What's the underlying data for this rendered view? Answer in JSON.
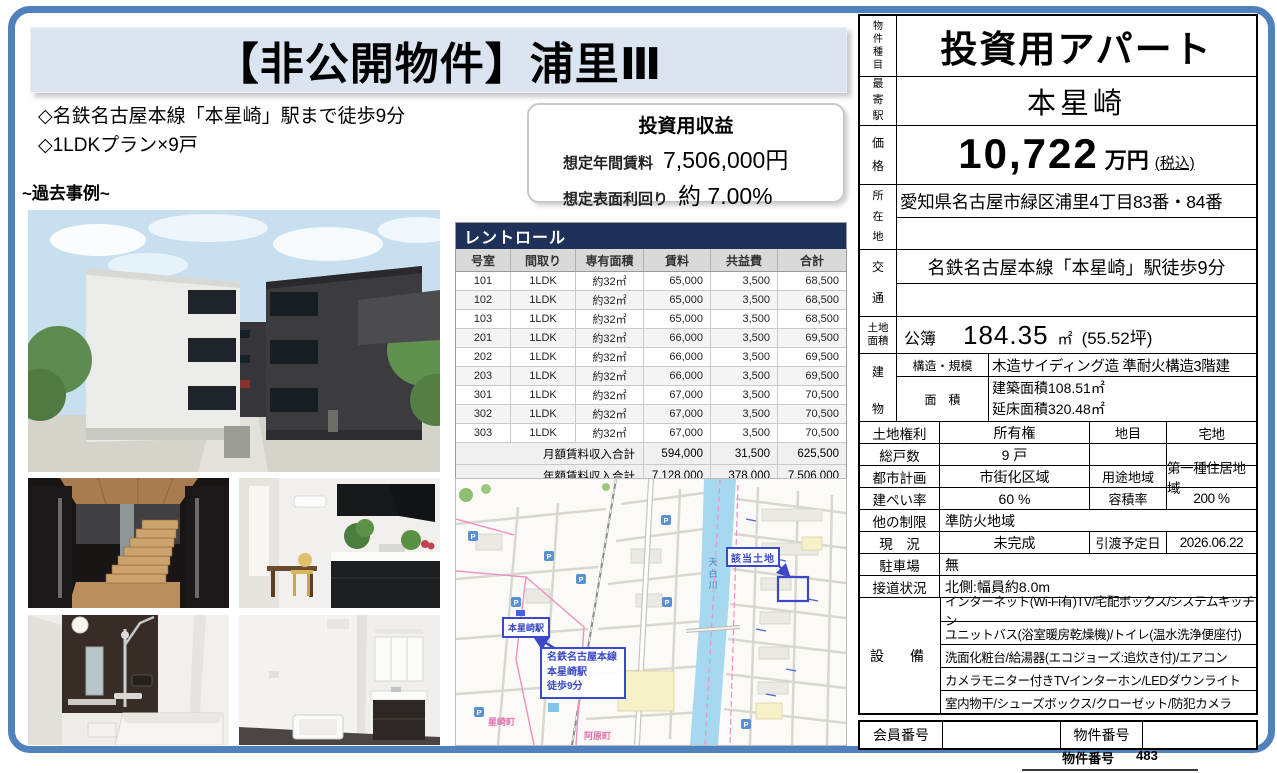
{
  "colors": {
    "accent_blue": "#4f81bd",
    "navy_header": "#1f3158",
    "title_bg": "#dbe5f1",
    "map_annotation_blue": "#3b49c8",
    "map_pink": "#ef8fc0",
    "map_river": "#a6d9ef"
  },
  "page": {
    "title": "【非公開物件】浦里Ⅲ",
    "bullet1": "◇名鉄名古屋本線「本星崎」駅まで徒歩9分",
    "bullet2": "◇1LDKプラン×9戸",
    "past_example_label": "~過去事例~",
    "footer_label": "物件番号",
    "footer_value": "483"
  },
  "income_box": {
    "title": "投資用収益",
    "annual_rent_label": "想定年間賃料",
    "annual_rent_value": "7,506,000円",
    "yield_label": "想定表面利回り",
    "yield_value": "約 7.00%"
  },
  "rent_roll": {
    "title": "レントロール",
    "columns": [
      "号室",
      "間取り",
      "専有面積",
      "賃料",
      "共益費",
      "合計"
    ],
    "rows": [
      {
        "room": "101",
        "layout": "1LDK",
        "area": "約32㎡",
        "rent": "65,000",
        "fee": "3,500",
        "total": "68,500"
      },
      {
        "room": "102",
        "layout": "1LDK",
        "area": "約32㎡",
        "rent": "65,000",
        "fee": "3,500",
        "total": "68,500"
      },
      {
        "room": "103",
        "layout": "1LDK",
        "area": "約32㎡",
        "rent": "65,000",
        "fee": "3,500",
        "total": "68,500"
      },
      {
        "room": "201",
        "layout": "1LDK",
        "area": "約32㎡",
        "rent": "66,000",
        "fee": "3,500",
        "total": "69,500"
      },
      {
        "room": "202",
        "layout": "1LDK",
        "area": "約32㎡",
        "rent": "66,000",
        "fee": "3,500",
        "total": "69,500"
      },
      {
        "room": "203",
        "layout": "1LDK",
        "area": "約32㎡",
        "rent": "66,000",
        "fee": "3,500",
        "total": "69,500"
      },
      {
        "room": "301",
        "layout": "1LDK",
        "area": "約32㎡",
        "rent": "67,000",
        "fee": "3,500",
        "total": "70,500"
      },
      {
        "room": "302",
        "layout": "1LDK",
        "area": "約32㎡",
        "rent": "67,000",
        "fee": "3,500",
        "total": "70,500"
      },
      {
        "room": "303",
        "layout": "1LDK",
        "area": "約32㎡",
        "rent": "67,000",
        "fee": "3,500",
        "total": "70,500"
      }
    ],
    "totals": [
      {
        "label": "月額賃料収入合計",
        "rent": "594,000",
        "fee": "31,500",
        "total": "625,500"
      },
      {
        "label": "年額賃料収入合計",
        "rent": "7,128,000",
        "fee": "378,000",
        "total": "7,506,000"
      }
    ]
  },
  "map": {
    "subject_label": "該当土地",
    "station_label": "本星崎駅",
    "route_line1": "名鉄名古屋本線",
    "route_line2": "本星崎駅",
    "route_line3": "徒歩9分",
    "river_label": "天白川",
    "town_label1": "星崎町",
    "town_label2": "阿原町",
    "parking_label": "P"
  },
  "right_panel": {
    "property_type_label": "物件種目",
    "property_type": "投資用アパート",
    "station_label": "最寄駅",
    "station": "本星崎",
    "price_label": "価格",
    "price": "10,722",
    "price_unit": "万円",
    "price_tax": "(税込)",
    "location_label": "所在地",
    "location": "愛知県名古屋市緑区浦里4丁目83番・84番",
    "transport_label": "交通",
    "transport": "名鉄名古屋本線「本星崎」駅徒歩9分",
    "land_label": "土地面積",
    "land_registry": "公簿",
    "land_value": "184.35",
    "land_unit": "㎡",
    "land_tsubo": "(55.52坪)",
    "building_label": "建物",
    "structure_label": "構造・規模",
    "structure": "木造サイディング造 準耐火構造3階建",
    "barea_label": "面　積",
    "barea_line1": "建築面積108.51㎡",
    "barea_line2": "延床面積320.48㎡",
    "land_rights_label": "土地権利",
    "land_rights": "所有権",
    "chimoku_label": "地目",
    "chimoku": "宅地",
    "units_label": "総戸数",
    "units": "9 戸",
    "units_blank1": "",
    "units_blank2": "",
    "cityplan_label": "都市計画",
    "cityplan": "市街化区域",
    "youto_label": "用途地域",
    "youto": "第一種住居地域",
    "bcr_label": "建ぺい率",
    "bcr": "60 %",
    "far_label": "容積率",
    "far": "200 %",
    "other_label": "他の制限",
    "other": "準防火地域",
    "status_label": "現　況",
    "status": "未完成",
    "handover_label": "引渡予定日",
    "handover": "2026.06.22",
    "parking_label": "駐車場",
    "parking": "無",
    "road_label": "接道状況",
    "road": "北側:幅員約8.0m",
    "equipment_label": "設　備",
    "equipment": [
      "インターネット(Wi-Fi有)TV/宅配ボックス/システムキッチン",
      "ユニットバス(浴室暖房乾燥機)/トイレ(温水洗浄便座付)",
      "洗面化粧台/給湯器(エコジョーズ:追炊き付)/エアコン",
      "カメラモニター付きTVインターホン/LEDダウンライト",
      "室内物干/シューズボックス/クローゼット/防犯カメラ"
    ],
    "member_label": "会員番号",
    "member_value": "",
    "bukken_label": "物件番号",
    "bukken_value": ""
  }
}
